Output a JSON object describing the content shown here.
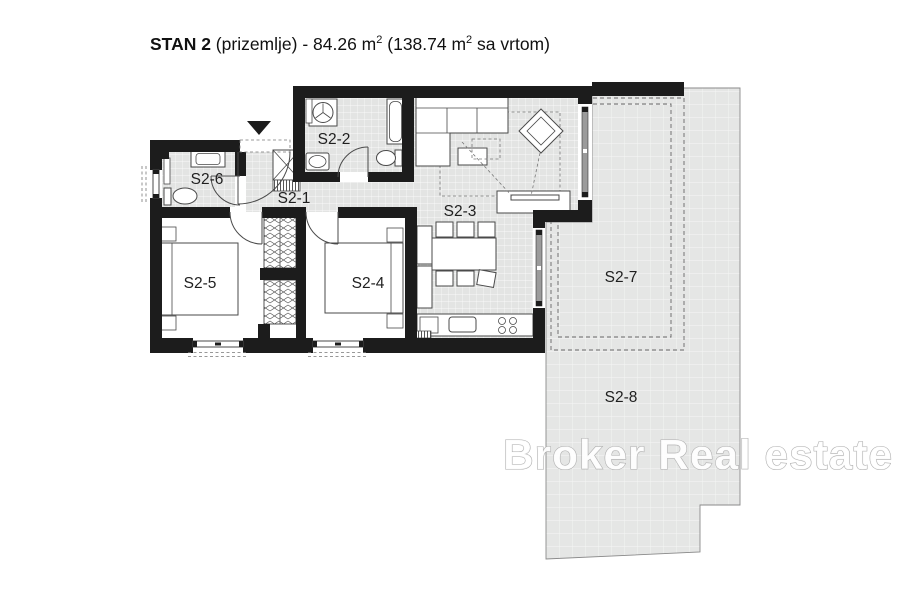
{
  "title": {
    "name": "STAN 2",
    "rest_1": " (prizemlje) - 84.26 m",
    "sup_1": "2",
    "rest_2": " (138.74 m",
    "sup_2": "2",
    "rest_3": " sa vrtom)"
  },
  "rooms": {
    "s2_1": "S2-1",
    "s2_2": "S2-2",
    "s2_3": "S2-3",
    "s2_4": "S2-4",
    "s2_5": "S2-5",
    "s2_6": "S2-6",
    "s2_7": "S2-7",
    "s2_8": "S2-8"
  },
  "watermark": "Broker Real estate",
  "colors": {
    "background": "#ffffff",
    "wall": "#1c1c1c",
    "floor_tile": "#e3e4e3",
    "tile_grid_line": "#ffffff",
    "outdoor_fill": "#e5e6e5",
    "outdoor_outline": "#8a8a8a",
    "furniture_stroke": "#4a4a4a",
    "label_text": "#1f1f1f",
    "door_glazing": "#9b9b9b",
    "dashed_boundary": "#666666",
    "watermark_fill": "#ffffff",
    "watermark_stroke": "#ababab"
  }
}
